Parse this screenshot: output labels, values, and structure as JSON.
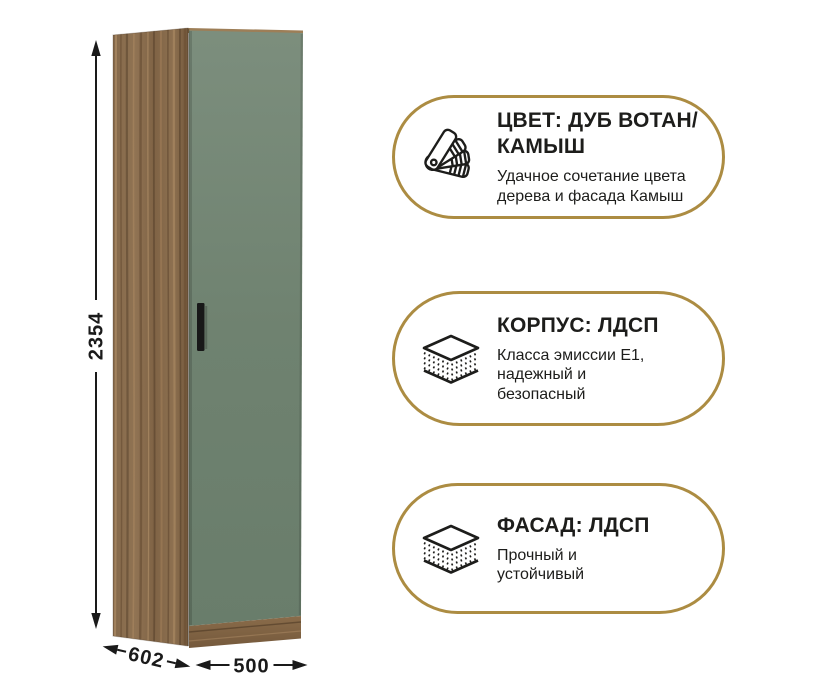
{
  "page": {
    "background": "#ffffff"
  },
  "wardrobe": {
    "description": "tall single-door wardrobe, oak wotan carcass with sage-green (reed) front",
    "dimensions": {
      "height_mm": "2354",
      "depth_mm": "602",
      "width_mm": "500"
    },
    "colors": {
      "wood_base": "#87694a",
      "wood_dark": "#6e5437",
      "wood_light": "#a5835d",
      "door_green": "#70836f",
      "handle_black": "#1a1a1a"
    }
  },
  "badges": [
    {
      "icon": "color-swatches-icon",
      "title": "ЦВЕТ: ДУБ ВОТАН/КАМЫШ",
      "subtitle": "Удачное сочетание цвета дерева и фасада Камыш"
    },
    {
      "icon": "layers-icon",
      "title": "КОРПУС: ЛДСП",
      "subtitle": "Класса эмиссии E1, надежный и безопасный"
    },
    {
      "icon": "layers-icon",
      "title": "ФАСАД: ЛДСП",
      "subtitle": "Прочный и устойчивый"
    }
  ],
  "theme": {
    "accent_gold": "#ac8c42",
    "text_color": "#1d1d1b",
    "dimension_line_color": "#1a1a1a"
  }
}
